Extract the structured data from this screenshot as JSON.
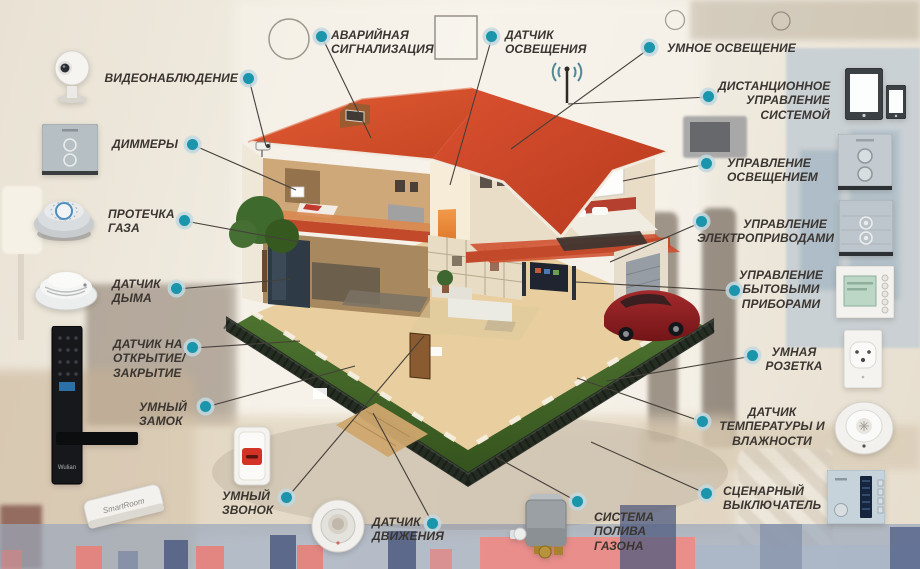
{
  "colors": {
    "dot": "#1b95ac",
    "label": "#3a3531",
    "line": "#45403a",
    "roof": "#d6502c",
    "lawn": "#47682b",
    "car": "#8e2025",
    "stripe-red": "#e8807a",
    "stripe-blue": "#4e5b80",
    "rug": "#9aa7ba"
  },
  "callouts": [
    {
      "id": "video-surveillance",
      "label": "ВИДЕОНАБЛЮДЕНИЕ"
    },
    {
      "id": "emergency-alarm",
      "label": "АВАРИЙНАЯ\nСИГНАЛИЗАЦИЯ"
    },
    {
      "id": "light-sensor",
      "label": "ДАТЧИК\nОСВЕЩЕНИЯ"
    },
    {
      "id": "smart-lighting",
      "label": "УМНОЕ ОСВЕЩЕНИЕ"
    },
    {
      "id": "remote-control",
      "label": "ДИСТАНЦИОННОЕ\nУПРАВЛЕНИЕ\nСИСТЕМОЙ"
    },
    {
      "id": "lighting-control",
      "label": "УПРАВЛЕНИЕ\nОСВЕЩЕНИЕМ"
    },
    {
      "id": "drives-control",
      "label": "УПРАВЛЕНИЕ\nЭЛЕКТРОПРИВОДАМИ"
    },
    {
      "id": "appliances-control",
      "label": "УПРАВЛЕНИЕ\nБЫТОВЫМИ\nПРИБОРАМИ"
    },
    {
      "id": "smart-socket",
      "label": "УМНАЯ\nРОЗЕТКА"
    },
    {
      "id": "temp-humidity",
      "label": "ДАТЧИК\nТЕМПЕРАТУРЫ И\nВЛАЖНОСТИ"
    },
    {
      "id": "scenario-switch",
      "label": "СЦЕНАРНЫЙ\nВЫКЛЮЧАТЕЛЬ"
    },
    {
      "id": "irrigation",
      "label": "СИСТЕМА\nПОЛИВА\nГАЗОНА"
    },
    {
      "id": "motion-sensor",
      "label": "ДАТЧИК\nДВИЖЕНИЯ"
    },
    {
      "id": "smart-doorbell",
      "label": "УМНЫЙ\nЗВОНОК"
    },
    {
      "id": "smart-lock",
      "label": "УМНЫЙ\nЗАМОК"
    },
    {
      "id": "open-close-sensor",
      "label": "ДАТЧИК НА\nОТКРЫТИЕ/\nЗАКРЫТИЕ"
    },
    {
      "id": "smoke-detector",
      "label": "ДАТЧИК\nДЫМА"
    },
    {
      "id": "gas-leak",
      "label": "ПРОТЕЧКА\nГАЗА"
    },
    {
      "id": "dimmers",
      "label": "ДИММЕРЫ"
    }
  ],
  "devices": [
    {
      "id": "ip-camera"
    },
    {
      "id": "dimmer-panel"
    },
    {
      "id": "gas-leak-detector"
    },
    {
      "id": "smoke-detector"
    },
    {
      "id": "smart-lock",
      "brand": "Wulian"
    },
    {
      "id": "door-wedge-sensor",
      "brand": "SmartRoom"
    },
    {
      "id": "doorbell-button"
    },
    {
      "id": "motion-sensor"
    },
    {
      "id": "irrigation-valve"
    },
    {
      "id": "tablet"
    },
    {
      "id": "smartphone"
    },
    {
      "id": "wall-switch-round-buttons"
    },
    {
      "id": "wall-switch-ring-buttons"
    },
    {
      "id": "thermostat"
    },
    {
      "id": "wall-socket"
    },
    {
      "id": "temp-humidity-sensor"
    },
    {
      "id": "scenario-switch-panel"
    }
  ]
}
